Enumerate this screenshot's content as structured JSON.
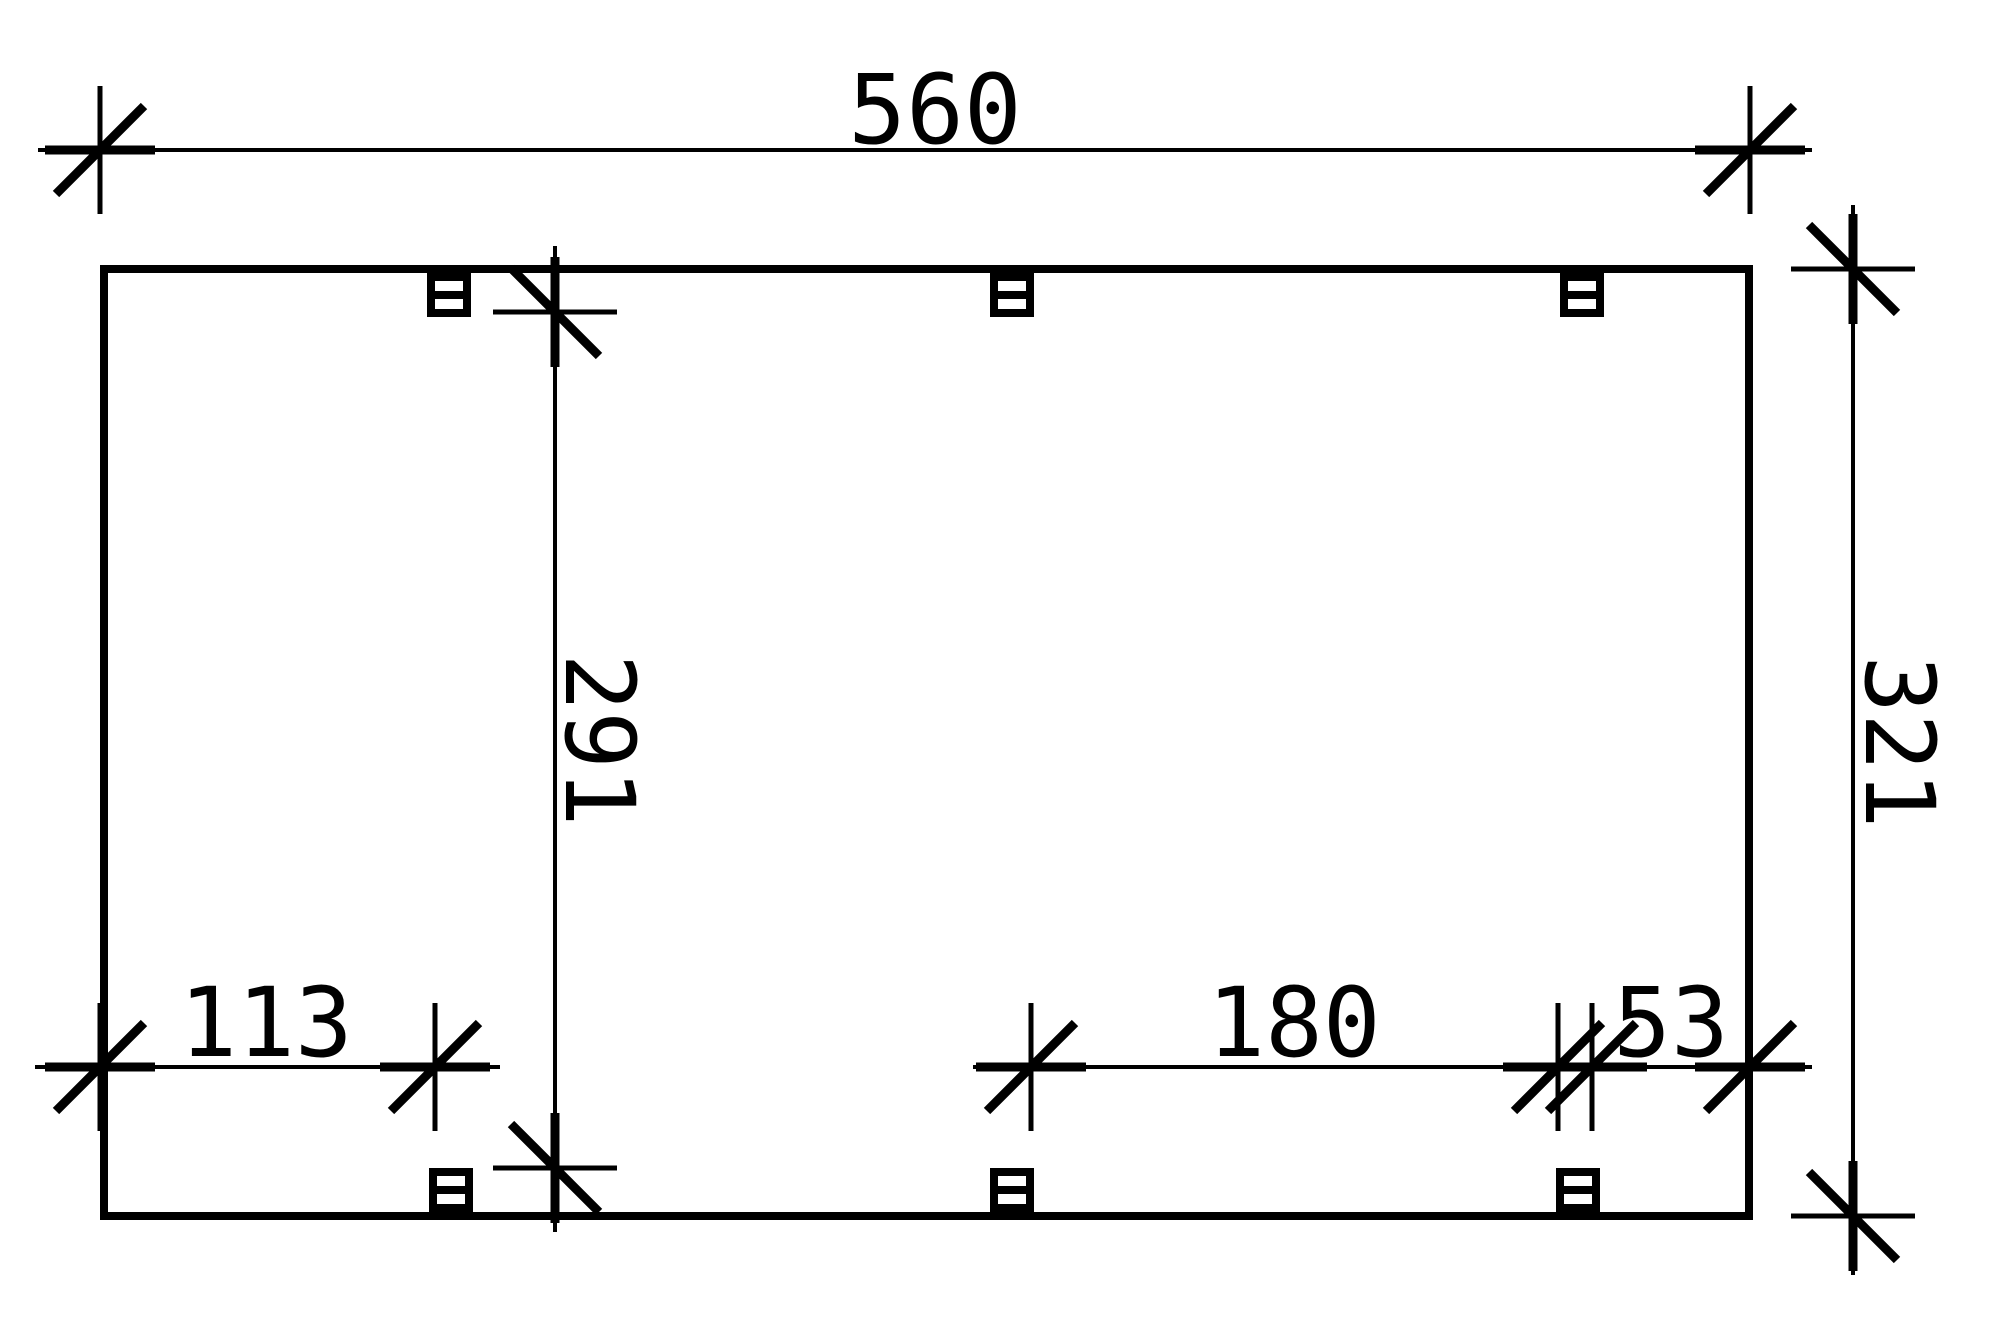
{
  "drawing": {
    "type": "technical-plan-top-view",
    "description": "Dimensioned top-view plan of a rectangular carport frame with three posts along the top beam and three posts along the bottom beam",
    "units_shown": "none (plain numbers, cm implied)",
    "colors": {
      "ink": "#000000",
      "background": "#ffffff"
    },
    "dimensions": {
      "top_width": {
        "label": "560",
        "orientation": "horizontal",
        "position": "above plan"
      },
      "overall_height": {
        "label": "321",
        "orientation": "vertical",
        "position": "right of plan"
      },
      "inner_height": {
        "label": "291",
        "orientation": "vertical",
        "position": "inside plan, left-center"
      },
      "bottom_left": {
        "label": "113",
        "orientation": "horizontal",
        "position": "inside plan, bottom left"
      },
      "bottom_middle": {
        "label": "180",
        "orientation": "horizontal",
        "position": "inside plan, bottom right span"
      },
      "bottom_right": {
        "label": "53",
        "orientation": "horizontal",
        "position": "inside plan, bottom right corner"
      }
    },
    "posts": {
      "symbol": "square-post-cross-section",
      "count_top_edge": 3,
      "count_bottom_edge": 3
    }
  }
}
